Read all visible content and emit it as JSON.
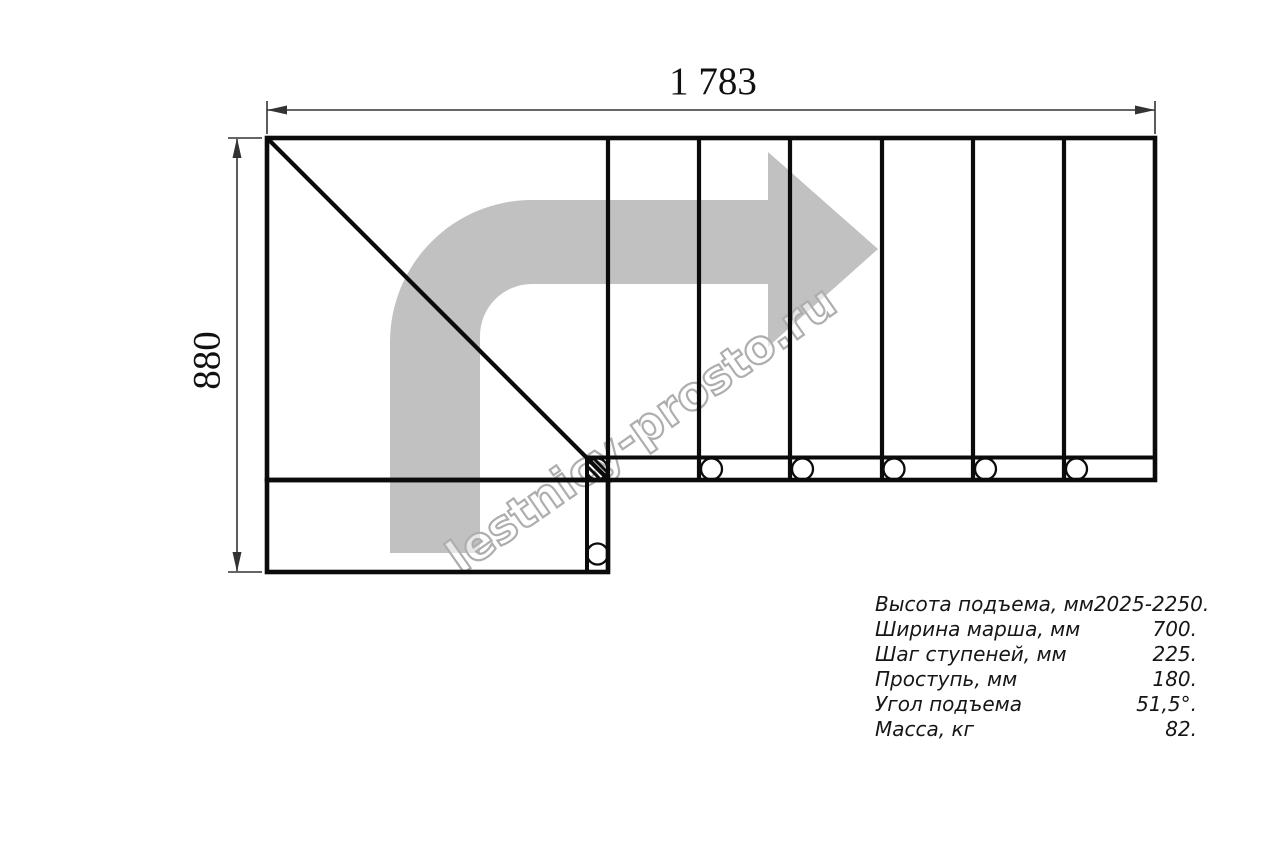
{
  "drawing": {
    "top_dimension_label": "1 783",
    "side_dimension_label": "880",
    "watermark_text": "lestnicy-prosto.ru",
    "colors": {
      "line": "#0b0b0b",
      "arrow": "#c1c1c1",
      "dimension": "#333333",
      "watermark_outline": "#aeaeae"
    }
  },
  "specs_table": {
    "rows": [
      {
        "label": "Высота подъема, мм",
        "value": "2025-2250."
      },
      {
        "label": "Ширина марша, мм",
        "value": "700."
      },
      {
        "label": "Шаг ступеней, мм",
        "value": "225."
      },
      {
        "label": "Проступь, мм",
        "value": "180."
      },
      {
        "label": "Угол подъема",
        "value": "51,5°."
      },
      {
        "label": "Масса, кг",
        "value": "82."
      }
    ]
  }
}
